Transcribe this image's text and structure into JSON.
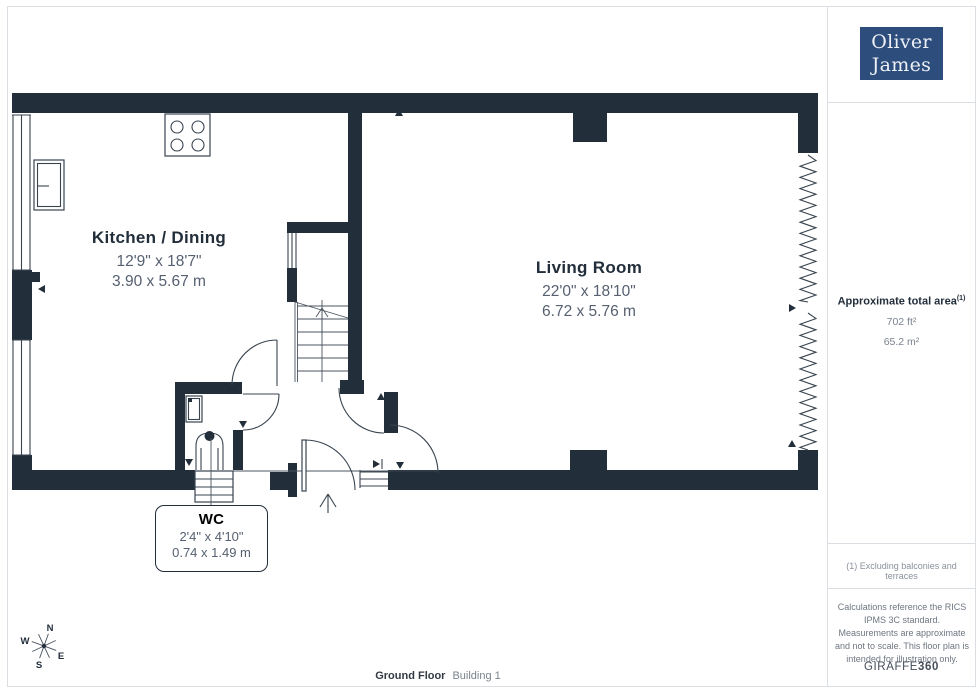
{
  "logo": {
    "line1": "Oliver",
    "line2": "James"
  },
  "rooms": {
    "kitchen": {
      "name": "Kitchen / Dining",
      "imperial": "12'9\" x 18'7\"",
      "metric": "3.90 x 5.67 m"
    },
    "living": {
      "name": "Living Room",
      "imperial": "22'0\" x 18'10\"",
      "metric": "6.72 x 5.76 m"
    },
    "wc": {
      "name": "WC",
      "imperial": "2'4\" x 4'10\"",
      "metric": "0.74 x 1.49 m"
    }
  },
  "sidebar": {
    "area_label": "Approximate total area",
    "area_footnote_ref": "(1)",
    "area_imperial": "702 ft²",
    "area_metric": "65.2 m²",
    "footnote": "(1) Excluding balconies and terraces",
    "disclaimer": "Calculations reference the RICS IPMS 3C standard. Measurements are approximate and not to scale. This floor plan is intended for illustration only.",
    "brand_name": "GIRAFFE",
    "brand_number": "360"
  },
  "footer": {
    "floor": "Ground Floor",
    "building": "Building 1"
  },
  "compass": {
    "n": "N",
    "e": "E",
    "s": "S",
    "w": "W"
  },
  "icons": [
    "stove-icon",
    "kitchen-sink-icon",
    "wc-sink-icon",
    "toilet-icon",
    "stairs-icon",
    "compass-rose-icon",
    "entrance-arrow-icon",
    "bifold-door-icon"
  ],
  "colors": {
    "wall": "#232e3b",
    "logo_background": "#2d4d7c",
    "text_dark": "#232e3b",
    "text_muted": "#566070",
    "divider": "#dadde2"
  }
}
